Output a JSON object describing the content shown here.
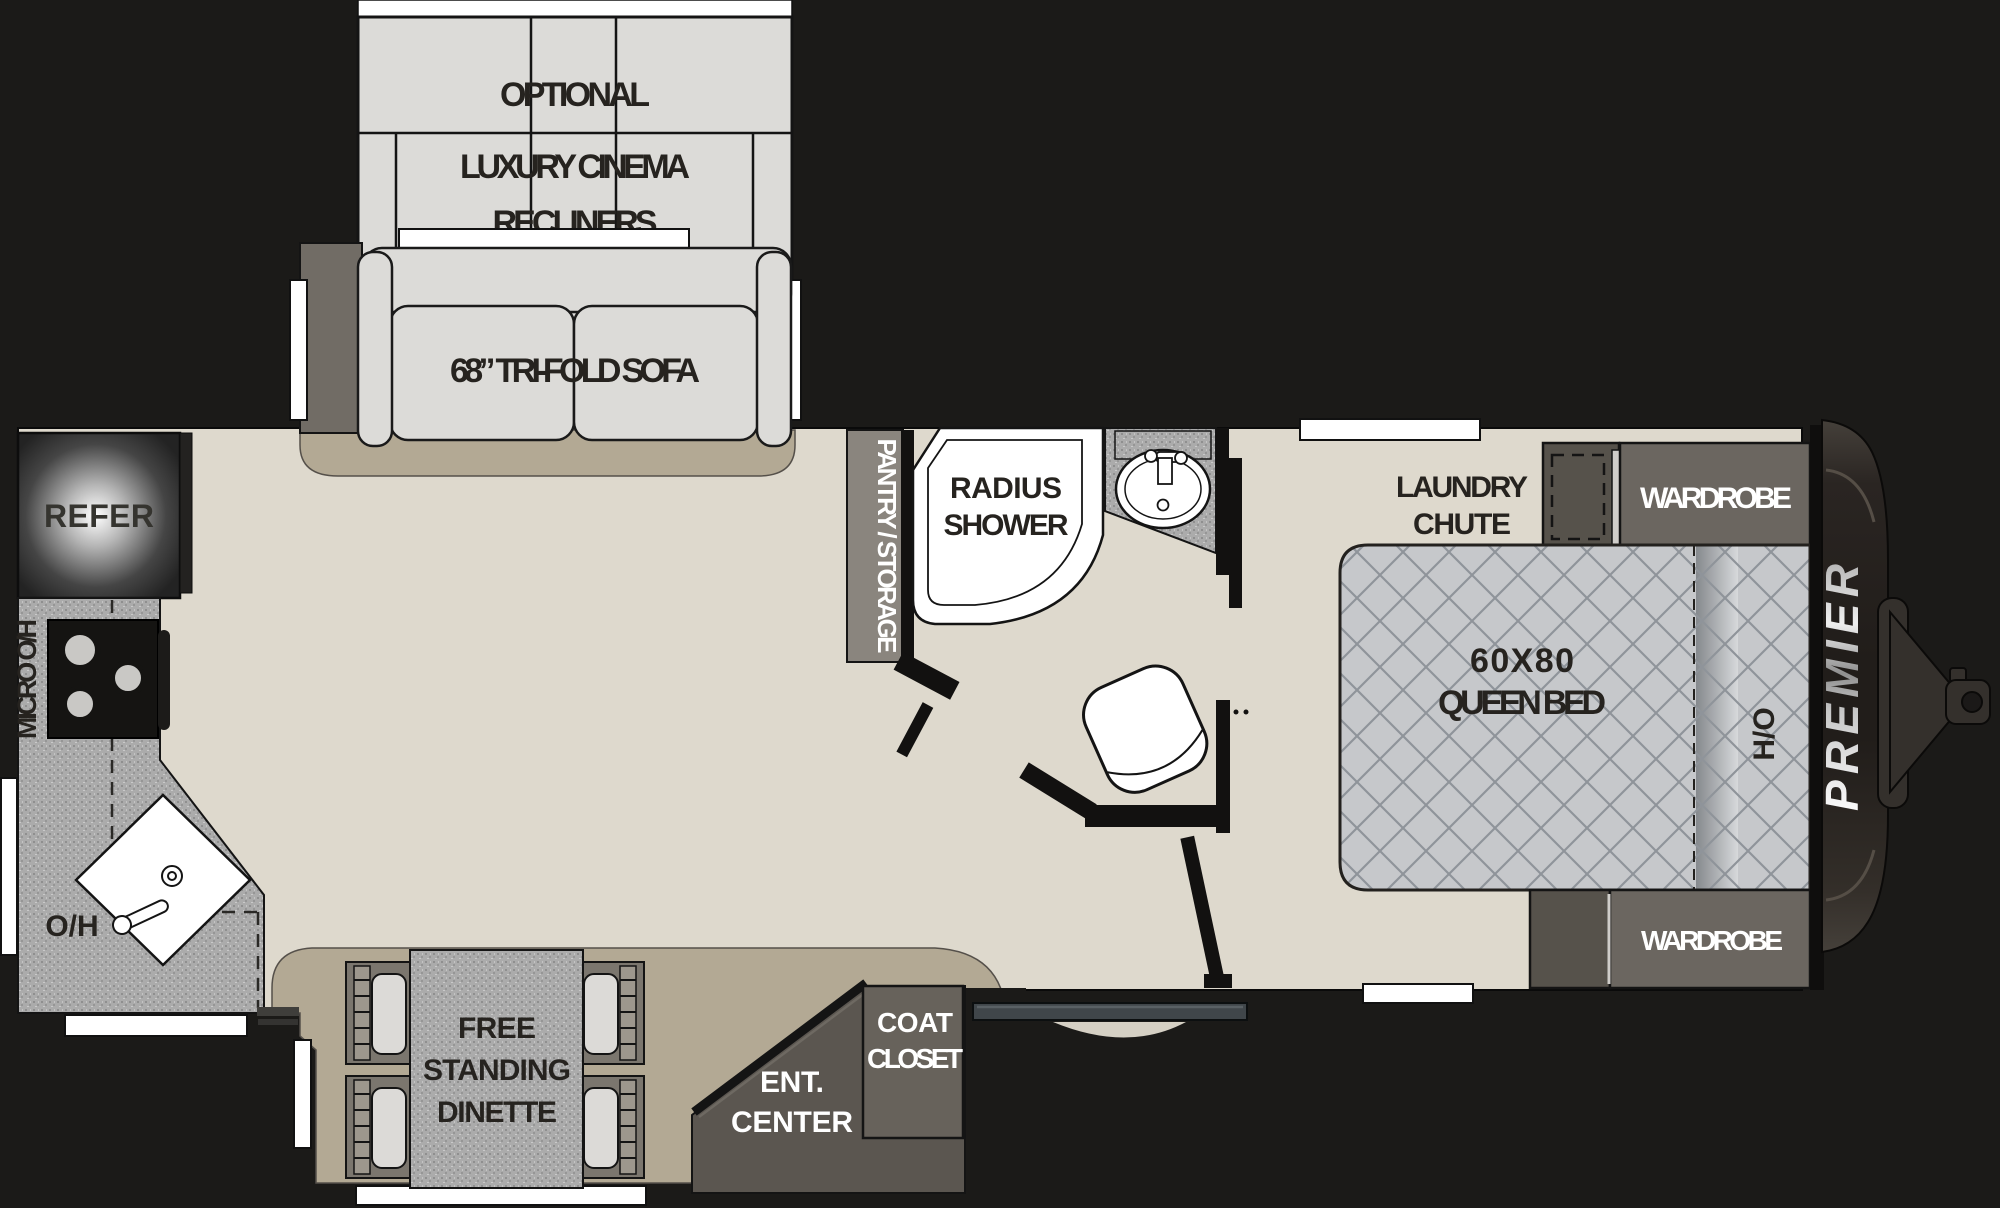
{
  "floorplan": {
    "type": "travel-trailer-floorplan",
    "brand": "PREMIER",
    "labels": {
      "recliners": [
        "OPTIONAL",
        "LUXURY CINEMA",
        "RECLINERS"
      ],
      "sofa": "68” TRI-FOLD SOFA",
      "refrigerator": "REFER",
      "microwave_overhead": "MICRO O/H",
      "overhead_cabinet": "O/H",
      "dinette": [
        "FREE",
        "STANDING",
        "DINETTE"
      ],
      "entertainment_center": [
        "ENT.",
        "CENTER"
      ],
      "coat_closet": [
        "COAT",
        "CLOSET"
      ],
      "pantry": "PANTRY / STORAGE",
      "shower": [
        "RADIUS",
        "SHOWER"
      ],
      "laundry_chute": [
        "LAUNDRY",
        "CHUTE"
      ],
      "wardrobe_front": "WARDROBE",
      "queen_bed": [
        "60X80",
        "QUEEN BED"
      ],
      "headboard_overhead": "H/O",
      "wardrobe_rear": "WARDROBE"
    },
    "colors": {
      "background": "#1b1a18",
      "floor_main": "#ded9cd",
      "floor_slideout": "#b3a994",
      "furniture_light": "#dcdbd8",
      "counter_speckle": "#ababab",
      "cabinet_dark": "#56524b",
      "cabinet_mid": "#67625b",
      "bed_quilt": "#c6c8cb",
      "label_dark": "#26231f",
      "label_light": "#ffffff",
      "window": "#ffffff"
    }
  }
}
